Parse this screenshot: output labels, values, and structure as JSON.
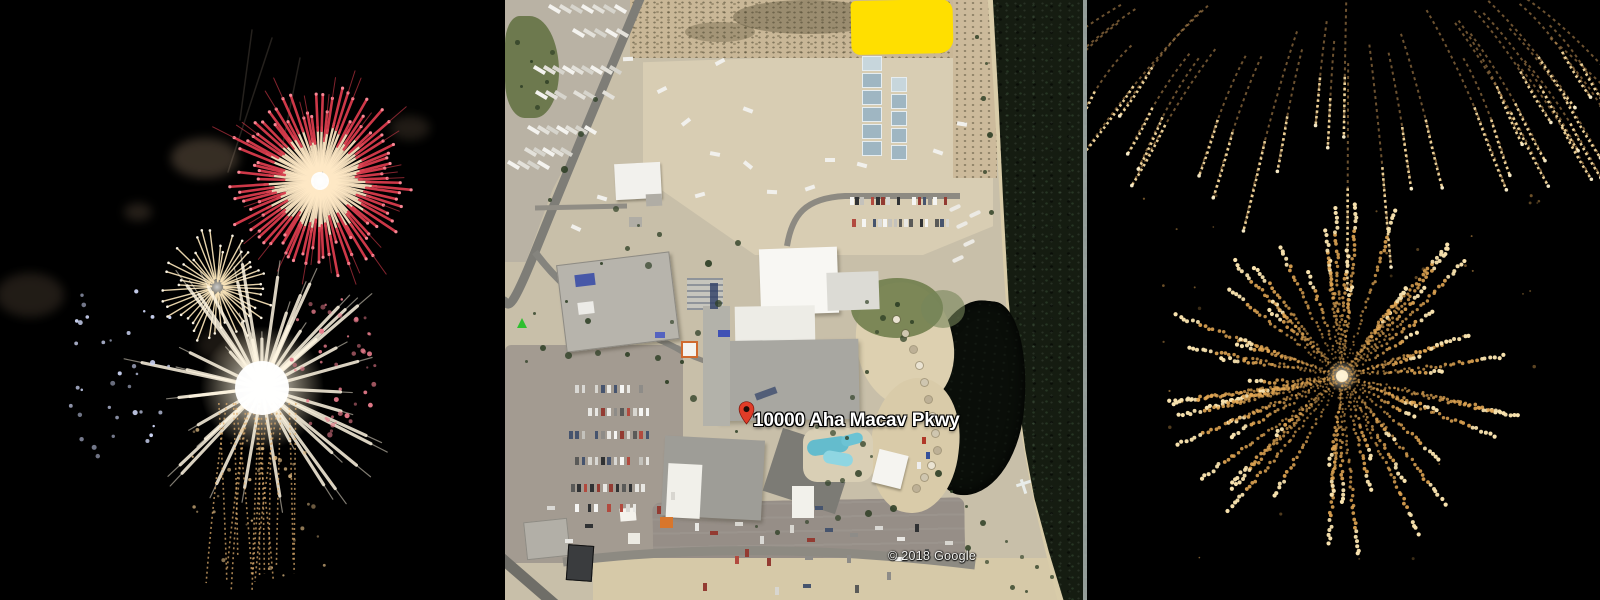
{
  "collage": {
    "description": "Fireworks photos flanking a satellite map of the venue",
    "left_photo": {
      "label": "fireworks burst photo, red white and gold",
      "background": "#000000"
    },
    "right_photo": {
      "label": "golden fireworks photo",
      "background": "#000000"
    }
  },
  "map": {
    "pin_label": "10000 Aha Macav Pkwy",
    "attribution": "© 2018 Google",
    "colors": {
      "highlight": "#ffdf00",
      "pin": "#e03c28",
      "ground": "#c8bfa9",
      "dirt_lot": "#d8cdb3",
      "scrub": "#c9b797",
      "road": "#7e7d77",
      "parking": "#a39b91",
      "building_white": "#f4f3ef",
      "building_gray": "#a8a7a1",
      "water": "#151c11",
      "lagoon": "#0a0e09",
      "beach": "#ddd0b0",
      "vegetation": "#5f6f40",
      "tree": "#2f4026",
      "pool": "#64bccd"
    }
  },
  "fireworks": {
    "left": {
      "width": 505,
      "bursts": [
        {
          "kind": "chrysanthemum",
          "cx": 320,
          "cy": 181,
          "r": 88,
          "rays": 88,
          "inner": "#ffe9c6",
          "tip": "#d93b4c",
          "tipdot": "#ff8f9c",
          "seed": 11
        },
        {
          "kind": "rayburst",
          "cx": 217,
          "cy": 287,
          "r": 54,
          "rays": 44,
          "color": "#ffe9bd",
          "seed": 21
        },
        {
          "kind": "coreburst",
          "cx": 262,
          "cy": 388,
          "r": 128,
          "streaks": 42,
          "color": "#fff6e2",
          "trail": "#dfae6e",
          "seed": 31
        },
        {
          "kind": "dotfield",
          "cx": 336,
          "cy": 362,
          "rx": 48,
          "ry": 75,
          "n": 48,
          "color": "#e87c8c",
          "seed": 41
        },
        {
          "kind": "dotfield",
          "cx": 120,
          "cy": 365,
          "rx": 58,
          "ry": 100,
          "n": 36,
          "color": "#ccd4f4",
          "seed": 51
        }
      ],
      "smoke": [
        [
          205,
          158,
          34,
          20,
          0.5
        ],
        [
          138,
          212,
          14,
          9,
          0.35
        ],
        [
          30,
          295,
          34,
          22,
          0.3
        ],
        [
          410,
          128,
          20,
          12,
          0.3
        ],
        [
          228,
          345,
          30,
          18,
          0.25
        ]
      ],
      "faint_trails": [
        [
          272,
          38,
          228,
          172
        ],
        [
          300,
          58,
          282,
          148
        ],
        [
          252,
          30,
          240,
          120
        ]
      ]
    },
    "right": {
      "width": 513,
      "trails": {
        "count": 36,
        "origin_x": 262,
        "origin_y": -110,
        "x_min": 28,
        "x_max": 492,
        "color": "#d9a45f",
        "tip": "#f6d99e",
        "seed": 61
      },
      "bursts": [
        {
          "kind": "granular",
          "cx": 255,
          "cy": 376,
          "r": 182,
          "rays": 68,
          "color": "#e2a754",
          "tip": "#f8e2ae",
          "seed": 71
        }
      ]
    }
  }
}
